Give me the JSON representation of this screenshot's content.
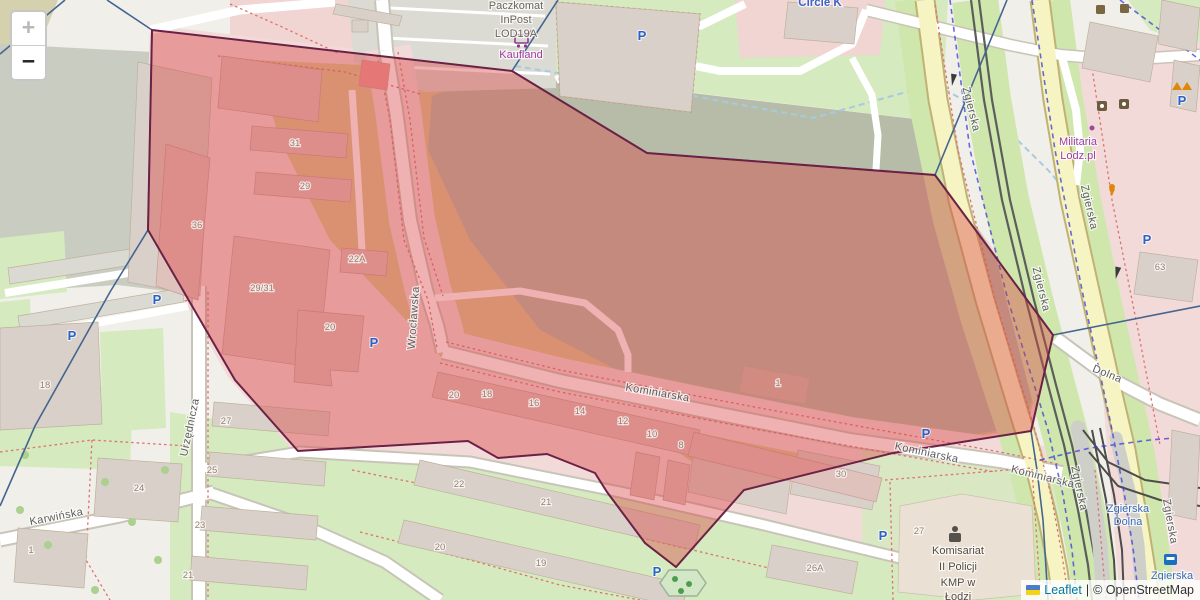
{
  "map": {
    "controls": {
      "zoom_in": "+",
      "zoom_out": "−"
    },
    "attribution": {
      "leaflet": "Leaflet",
      "separator": "|",
      "osm": "© OpenStreetMap"
    },
    "selection": {
      "points": "152,30 512,71 647,153 935,175 1053,335 1031,431 893,453 744,490 676,567 645,543 607,492 595,473 547,454 498,458 468,441 298,451 235,380 148,230",
      "fill": "#d84444",
      "fill_opacity": 0.42,
      "stroke": "#6b2145",
      "stroke_width": 2
    },
    "colors": {
      "admin_boundary": "#44658f",
      "water_path": "#a6cbe0",
      "cycleway": "#3b3bd8",
      "footpath_dashed": "#e07070",
      "main_road_yellow": "#f6f4c3",
      "leaflet_link": "#0078a8"
    },
    "labels": [
      {
        "t": "Wrocławska",
        "x": 417,
        "y": 318,
        "r": -86,
        "c": "st"
      },
      {
        "t": "Kominiarska",
        "x": 657,
        "y": 396,
        "r": 10,
        "c": "st"
      },
      {
        "t": "Kominiarska",
        "x": 926,
        "y": 456,
        "r": 12,
        "c": "st"
      },
      {
        "t": "Kominiarska",
        "x": 1042,
        "y": 480,
        "r": 14,
        "c": "st"
      },
      {
        "t": "Urzędnicza",
        "x": 193,
        "y": 428,
        "r": -78,
        "c": "st"
      },
      {
        "t": "Karwińska",
        "x": 57,
        "y": 520,
        "r": -11,
        "c": "st"
      },
      {
        "t": "Zgierska",
        "x": 968,
        "y": 110,
        "r": 76,
        "c": "st"
      },
      {
        "t": "Zgierska",
        "x": 1038,
        "y": 290,
        "r": 76,
        "c": "st"
      },
      {
        "t": "Zgierska",
        "x": 1076,
        "y": 489,
        "r": 78,
        "c": "st"
      },
      {
        "t": "Zgierska",
        "x": 1086,
        "y": 208,
        "r": 77,
        "c": "st"
      },
      {
        "t": "Zgierska",
        "x": 1167,
        "y": 522,
        "r": 80,
        "c": "st"
      },
      {
        "t": "Dolna",
        "x": 1106,
        "y": 377,
        "r": 22,
        "c": "st"
      },
      {
        "t": "Zgierska",
        "x": 1128,
        "y": 512,
        "c": "stn"
      },
      {
        "t": "Dolna",
        "x": 1128,
        "y": 525,
        "c": "stn"
      },
      {
        "t": "Zgierska",
        "x": 1172,
        "y": 579,
        "c": "stn"
      },
      {
        "t": "Paczkomat",
        "x": 516,
        "y": 9,
        "c": "poiG"
      },
      {
        "t": "InPost",
        "x": 516,
        "y": 23,
        "c": "poiG"
      },
      {
        "t": "LOD19A",
        "x": 516,
        "y": 37,
        "c": "poiG"
      },
      {
        "t": "Kaufland",
        "x": 521,
        "y": 58,
        "c": "poiP"
      },
      {
        "t": "Circle K",
        "x": 820,
        "y": 6,
        "c": "poiB"
      },
      {
        "t": "Militaria",
        "x": 1078,
        "y": 145,
        "c": "poiP"
      },
      {
        "t": "Lodz.pl",
        "x": 1078,
        "y": 159,
        "c": "poiP"
      },
      {
        "t": "Komisariat",
        "x": 958,
        "y": 554,
        "c": "poiD"
      },
      {
        "t": "II Policji",
        "x": 958,
        "y": 570,
        "c": "poiD"
      },
      {
        "t": "KMP w",
        "x": 958,
        "y": 586,
        "c": "poiD"
      },
      {
        "t": "Łodzi",
        "x": 958,
        "y": 600,
        "c": "poiD"
      },
      {
        "t": "31",
        "x": 295,
        "y": 146,
        "c": "num"
      },
      {
        "t": "29",
        "x": 305,
        "y": 189,
        "c": "num"
      },
      {
        "t": "36",
        "x": 197,
        "y": 228,
        "c": "num"
      },
      {
        "t": "29/31",
        "x": 262,
        "y": 291,
        "c": "num"
      },
      {
        "t": "22A",
        "x": 357,
        "y": 262,
        "c": "num"
      },
      {
        "t": "20",
        "x": 330,
        "y": 330,
        "c": "num"
      },
      {
        "t": "20",
        "x": 454,
        "y": 398,
        "c": "num"
      },
      {
        "t": "18",
        "x": 487,
        "y": 397,
        "c": "num"
      },
      {
        "t": "16",
        "x": 534,
        "y": 406,
        "c": "num"
      },
      {
        "t": "14",
        "x": 580,
        "y": 414,
        "c": "num"
      },
      {
        "t": "12",
        "x": 623,
        "y": 424,
        "c": "num"
      },
      {
        "t": "10",
        "x": 652,
        "y": 437,
        "c": "num"
      },
      {
        "t": "8",
        "x": 681,
        "y": 448,
        "c": "num"
      },
      {
        "t": "1",
        "x": 778,
        "y": 386,
        "c": "num"
      },
      {
        "t": "30",
        "x": 841,
        "y": 477,
        "c": "num"
      },
      {
        "t": "27",
        "x": 919,
        "y": 534,
        "c": "num"
      },
      {
        "t": "26A",
        "x": 815,
        "y": 571,
        "c": "num"
      },
      {
        "t": "22",
        "x": 459,
        "y": 487,
        "c": "num"
      },
      {
        "t": "21",
        "x": 546,
        "y": 505,
        "c": "num"
      },
      {
        "t": "20",
        "x": 440,
        "y": 550,
        "c": "num"
      },
      {
        "t": "19",
        "x": 541,
        "y": 566,
        "c": "num"
      },
      {
        "t": "18",
        "x": 45,
        "y": 388,
        "c": "num"
      },
      {
        "t": "27",
        "x": 226,
        "y": 424,
        "c": "num"
      },
      {
        "t": "25",
        "x": 212,
        "y": 473,
        "c": "num"
      },
      {
        "t": "23",
        "x": 200,
        "y": 528,
        "c": "num"
      },
      {
        "t": "21",
        "x": 188,
        "y": 578,
        "c": "num"
      },
      {
        "t": "24",
        "x": 139,
        "y": 491,
        "c": "num"
      },
      {
        "t": "1",
        "x": 31,
        "y": 553,
        "c": "num"
      },
      {
        "t": "63",
        "x": 1160,
        "y": 270,
        "c": "num"
      },
      {
        "t": "P",
        "x": 72,
        "y": 340,
        "c": "pk"
      },
      {
        "t": "P",
        "x": 157,
        "y": 304,
        "c": "pk"
      },
      {
        "t": "P",
        "x": 374,
        "y": 347,
        "c": "pk",
        "s": 15
      },
      {
        "t": "P",
        "x": 642,
        "y": 40,
        "c": "pk"
      },
      {
        "t": "P",
        "x": 926,
        "y": 438,
        "c": "pk",
        "s": 12
      },
      {
        "t": "P",
        "x": 883,
        "y": 540,
        "c": "pk",
        "s": 12
      },
      {
        "t": "P",
        "x": 657,
        "y": 576,
        "c": "pk",
        "s": 12
      },
      {
        "t": "P",
        "x": 1147,
        "y": 244,
        "c": "pk",
        "s": 17
      },
      {
        "t": "P",
        "x": 1182,
        "y": 105,
        "c": "pk"
      }
    ]
  }
}
